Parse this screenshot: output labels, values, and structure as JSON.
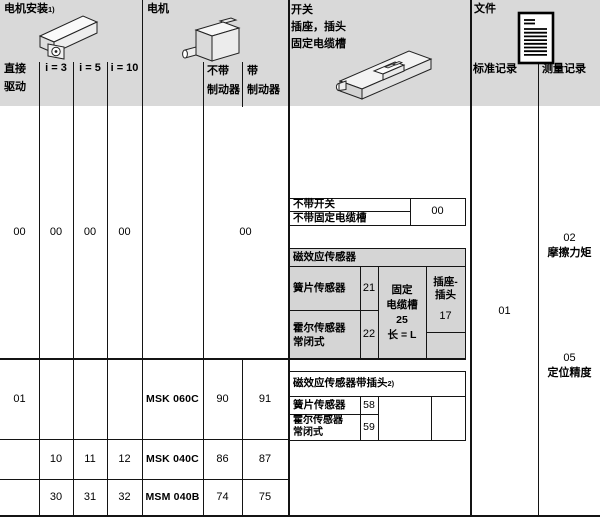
{
  "colors": {
    "band_gray": "#d9d9d9",
    "section_gray": "#d5d5d5",
    "line": "#141414"
  },
  "mount": {
    "title": "电机安装",
    "title_sup": "1)",
    "direct": "直接\n驱动",
    "i3": "i = 3",
    "i5": "i = 5",
    "i10": "i = 10"
  },
  "motor": {
    "title": "电机",
    "no_brake": "不带\n制动器",
    "brake": "带\n制动器"
  },
  "switch": {
    "title": "开关\n插座，插头\n固定电缆槽",
    "no_switch": {
      "line1": "不带开关",
      "line2": "不带固定电缆槽",
      "value": "00"
    },
    "sensors": {
      "header": "磁效应传感器",
      "rows": [
        {
          "label": "簧片传感器",
          "value": "21"
        },
        {
          "label": "霍尔传感器\n常闭式",
          "value": "22"
        }
      ],
      "duct": "固定\n电缆槽\n25\n长 = L",
      "plug": "插座-\n插头",
      "plug_value": "17"
    },
    "sensors_plug": {
      "header": "磁效应传感器带插头",
      "header_sup": "2)",
      "rows": [
        {
          "label": "簧片传感器",
          "value": "58"
        },
        {
          "label": "霍尔传感器\n常闭式",
          "value": "59"
        }
      ]
    }
  },
  "docs": {
    "title": "文件",
    "standard": "标准记录",
    "measure": "测量记录",
    "standard_value": "01",
    "measure_items": [
      {
        "code": "02",
        "label": "摩擦力矩"
      },
      {
        "code": "05",
        "label": "定位精度"
      }
    ]
  },
  "rows": [
    {
      "direct": "00",
      "i3": "00",
      "i5": "00",
      "i10": "00",
      "motor_type": "",
      "motor_code": "00"
    },
    {
      "direct": "01",
      "i3": "",
      "i5": "",
      "i10": "",
      "motor_type": "MSK 060C",
      "no_brake": "90",
      "brake": "91"
    },
    {
      "direct": "",
      "i3": "10",
      "i5": "11",
      "i10": "12",
      "motor_type": "MSK 040C",
      "no_brake": "86",
      "brake": "87"
    },
    {
      "direct": "",
      "i3": "30",
      "i5": "31",
      "i10": "32",
      "motor_type": "MSM 040B",
      "no_brake": "74",
      "brake": "75"
    }
  ]
}
